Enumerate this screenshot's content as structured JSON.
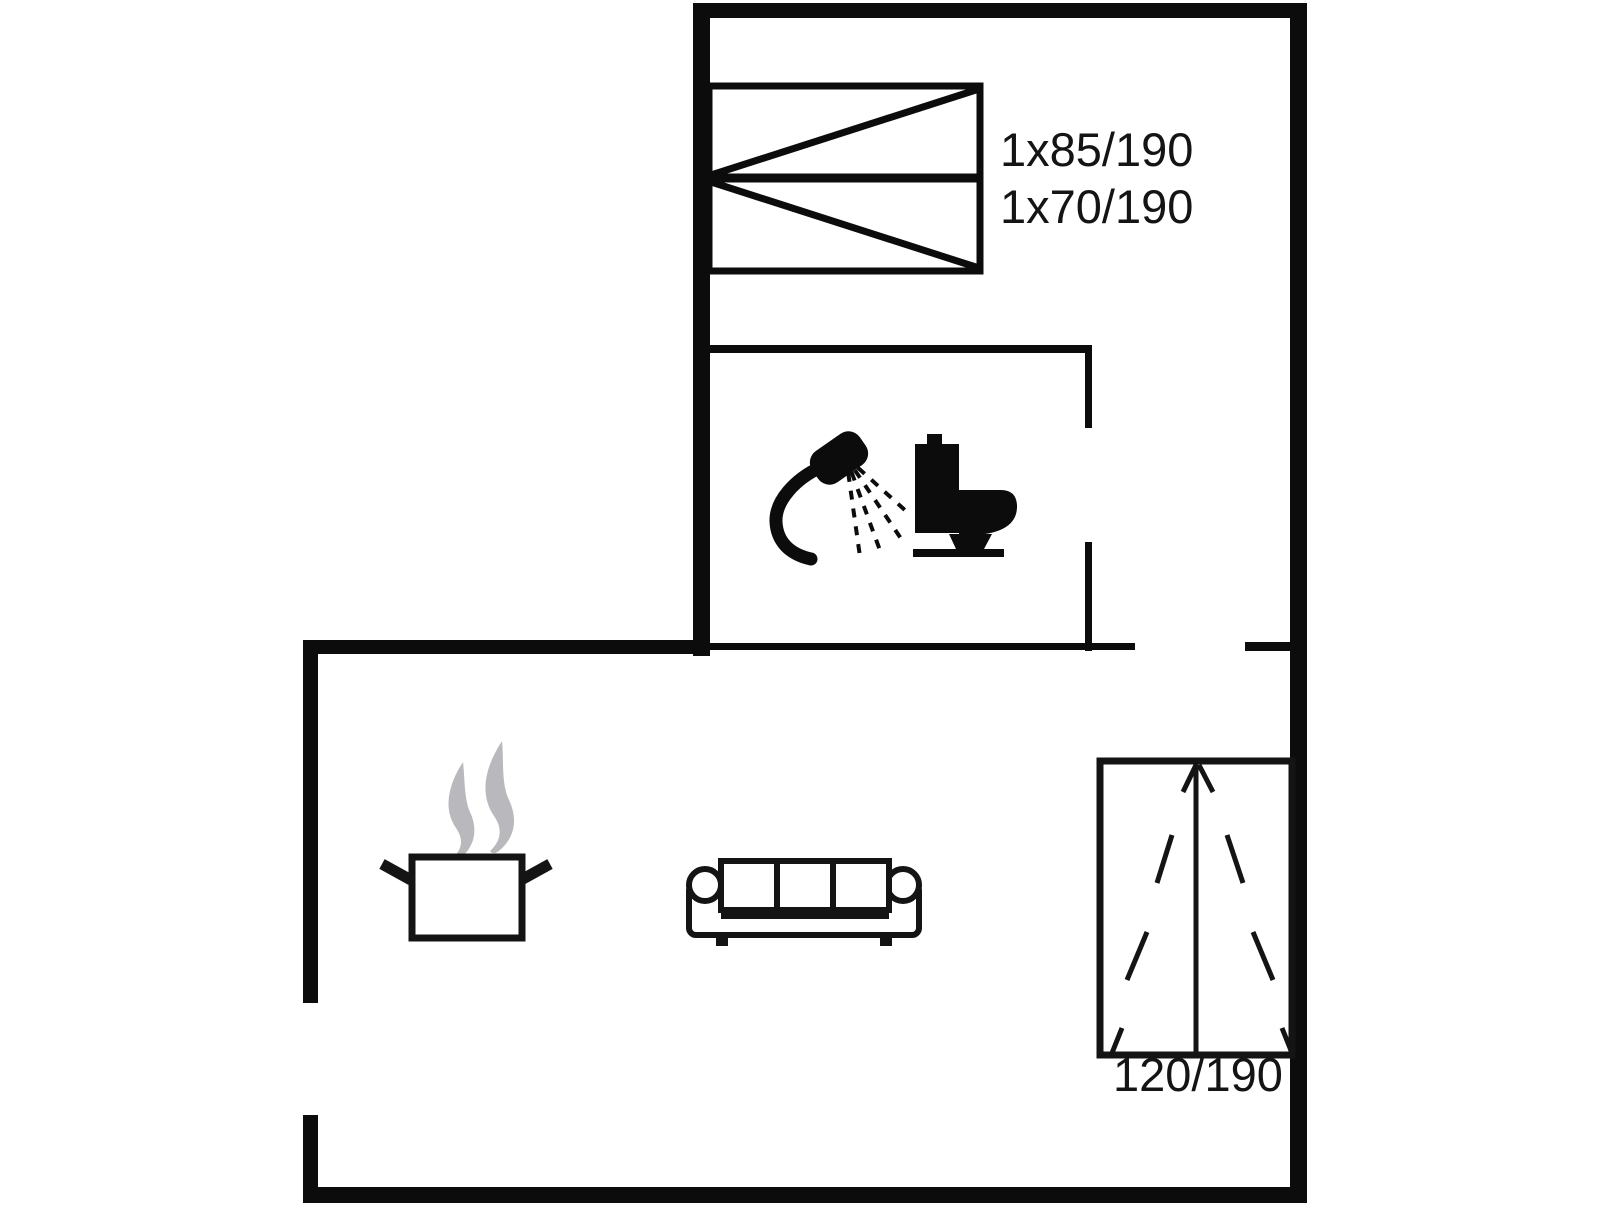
{
  "floorplan": {
    "colors": {
      "wall": "#0c0c0c",
      "line": "#141414",
      "background": "#ffffff",
      "steam": "#b9b9bd"
    },
    "labels": {
      "bunk_top": "1x85/190",
      "bunk_bottom": "1x70/190",
      "double_bed": "120/190"
    },
    "icons": [
      "bunk-bed-icon",
      "shower-icon",
      "toilet-icon",
      "cooking-pot-icon",
      "steam-icon",
      "sofa-icon",
      "double-bed-icon"
    ]
  }
}
